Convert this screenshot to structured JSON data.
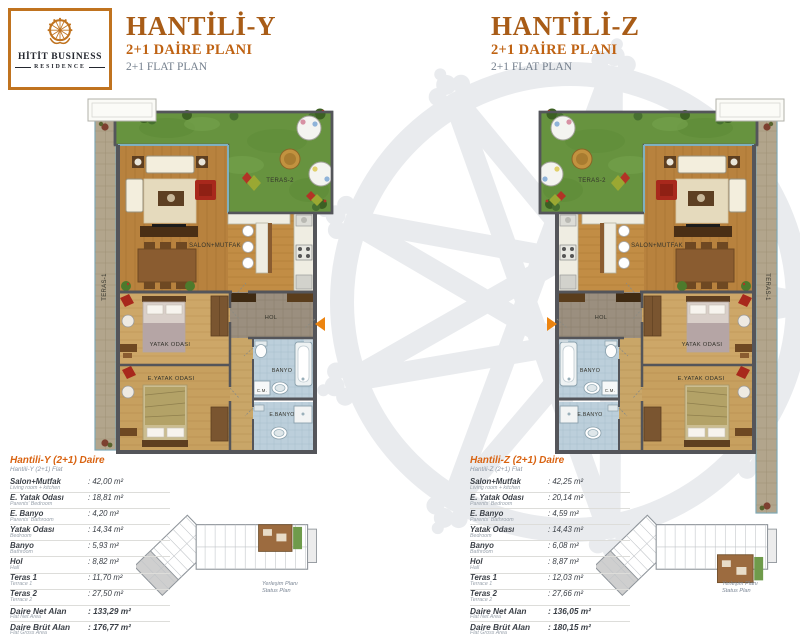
{
  "brand": {
    "logo_line1": "HİTİT BUSINESS",
    "logo_line2": "RESIDENCE",
    "logo_icon": "hittite-sun-icon"
  },
  "colors": {
    "accent": "#c0731f",
    "heading": "#a85c17",
    "subheading": "#bf6212",
    "table_title": "#d96311",
    "watermark": "#e9ebee",
    "entrance_arrow": "#ec8410",
    "grass": "#67933f",
    "wall": "#54555a"
  },
  "plan_labels": {
    "teras1": "TERAS-1",
    "teras2": "TERAS-2",
    "salon_mutfak": "SALON+MUTFAK",
    "hol": "HOL",
    "banyo": "BANYO",
    "cm": "C.M.",
    "e_banyo": "E.BANYO",
    "yatak_odasi": "YATAK ODASI",
    "e_yatak_odasi": "E.YATAK ODASI"
  },
  "keyplan_caption": {
    "tr": "Yerleşim Planı",
    "en": "Status Plan"
  },
  "units": [
    {
      "title": "HANTİLİ-Y",
      "subtitle_tr": "2+1 DAİRE PLANI",
      "subtitle_en": "2+1 FLAT PLAN",
      "table_title": "Hantili-Y (2+1) Daire",
      "table_subtitle": "Hantili-Y (2+1) Flat",
      "rows": [
        {
          "label": "Salon+Mutfak",
          "sublabel": "Living room + kitchen",
          "value": ": 42,00 m²",
          "bold": false
        },
        {
          "label": "E. Yatak Odası",
          "sublabel": "Parents' Bedroom",
          "value": ": 18,81 m²",
          "bold": false
        },
        {
          "label": "E. Banyo",
          "sublabel": "Parents' Bathroom",
          "value": ": 4,20 m²",
          "bold": false
        },
        {
          "label": "Yatak Odası",
          "sublabel": "Bedroom",
          "value": ": 14,34 m²",
          "bold": false
        },
        {
          "label": "Banyo",
          "sublabel": "Bathroom",
          "value": ": 5,93 m²",
          "bold": false
        },
        {
          "label": "Hol",
          "sublabel": "Hall",
          "value": ": 8,82 m²",
          "bold": false
        },
        {
          "label": "Teras 1",
          "sublabel": "Terrace 1",
          "value": ": 11,70 m²",
          "bold": false
        },
        {
          "label": "Teras 2",
          "sublabel": "Terrace 2",
          "value": ": 27,50 m²",
          "bold": false
        },
        {
          "label": "Daire Net Alan",
          "sublabel": "Flat Net Area",
          "value": ": 133,29 m²",
          "bold": true
        },
        {
          "label": "Daire Brüt Alan",
          "sublabel": "Flat Gross Area",
          "value": ": 176,77 m²",
          "bold": true
        }
      ]
    },
    {
      "title": "HANTİLİ-Z",
      "subtitle_tr": "2+1 DAİRE PLANI",
      "subtitle_en": "2+1 FLAT PLAN",
      "table_title": "Hantili-Z (2+1) Daire",
      "table_subtitle": "Hantili-Z (2+1) Flat",
      "rows": [
        {
          "label": "Salon+Mutfak",
          "sublabel": "Living room + kitchen",
          "value": ": 42,25 m²",
          "bold": false
        },
        {
          "label": "E. Yatak Odası",
          "sublabel": "Parents' Bedroom",
          "value": ": 20,14 m²",
          "bold": false
        },
        {
          "label": "E. Banyo",
          "sublabel": "Parents' Bathroom",
          "value": ": 4,59 m²",
          "bold": false
        },
        {
          "label": "Yatak Odası",
          "sublabel": "Bedroom",
          "value": ": 14,43 m²",
          "bold": false
        },
        {
          "label": "Banyo",
          "sublabel": "Bathroom",
          "value": ": 6,08 m²",
          "bold": false
        },
        {
          "label": "Hol",
          "sublabel": "Hall",
          "value": ": 8,87 m²",
          "bold": false
        },
        {
          "label": "Teras 1",
          "sublabel": "Terrace 1",
          "value": ": 12,03 m²",
          "bold": false
        },
        {
          "label": "Teras 2",
          "sublabel": "Terrace 2",
          "value": ": 27,66 m²",
          "bold": false
        },
        {
          "label": "Daire Net Alan",
          "sublabel": "Flat Net Area",
          "value": ": 136,05 m²",
          "bold": true
        },
        {
          "label": "Daire Brüt Alan",
          "sublabel": "Flat Gross Area",
          "value": ": 180,15 m²",
          "bold": true
        }
      ]
    }
  ]
}
